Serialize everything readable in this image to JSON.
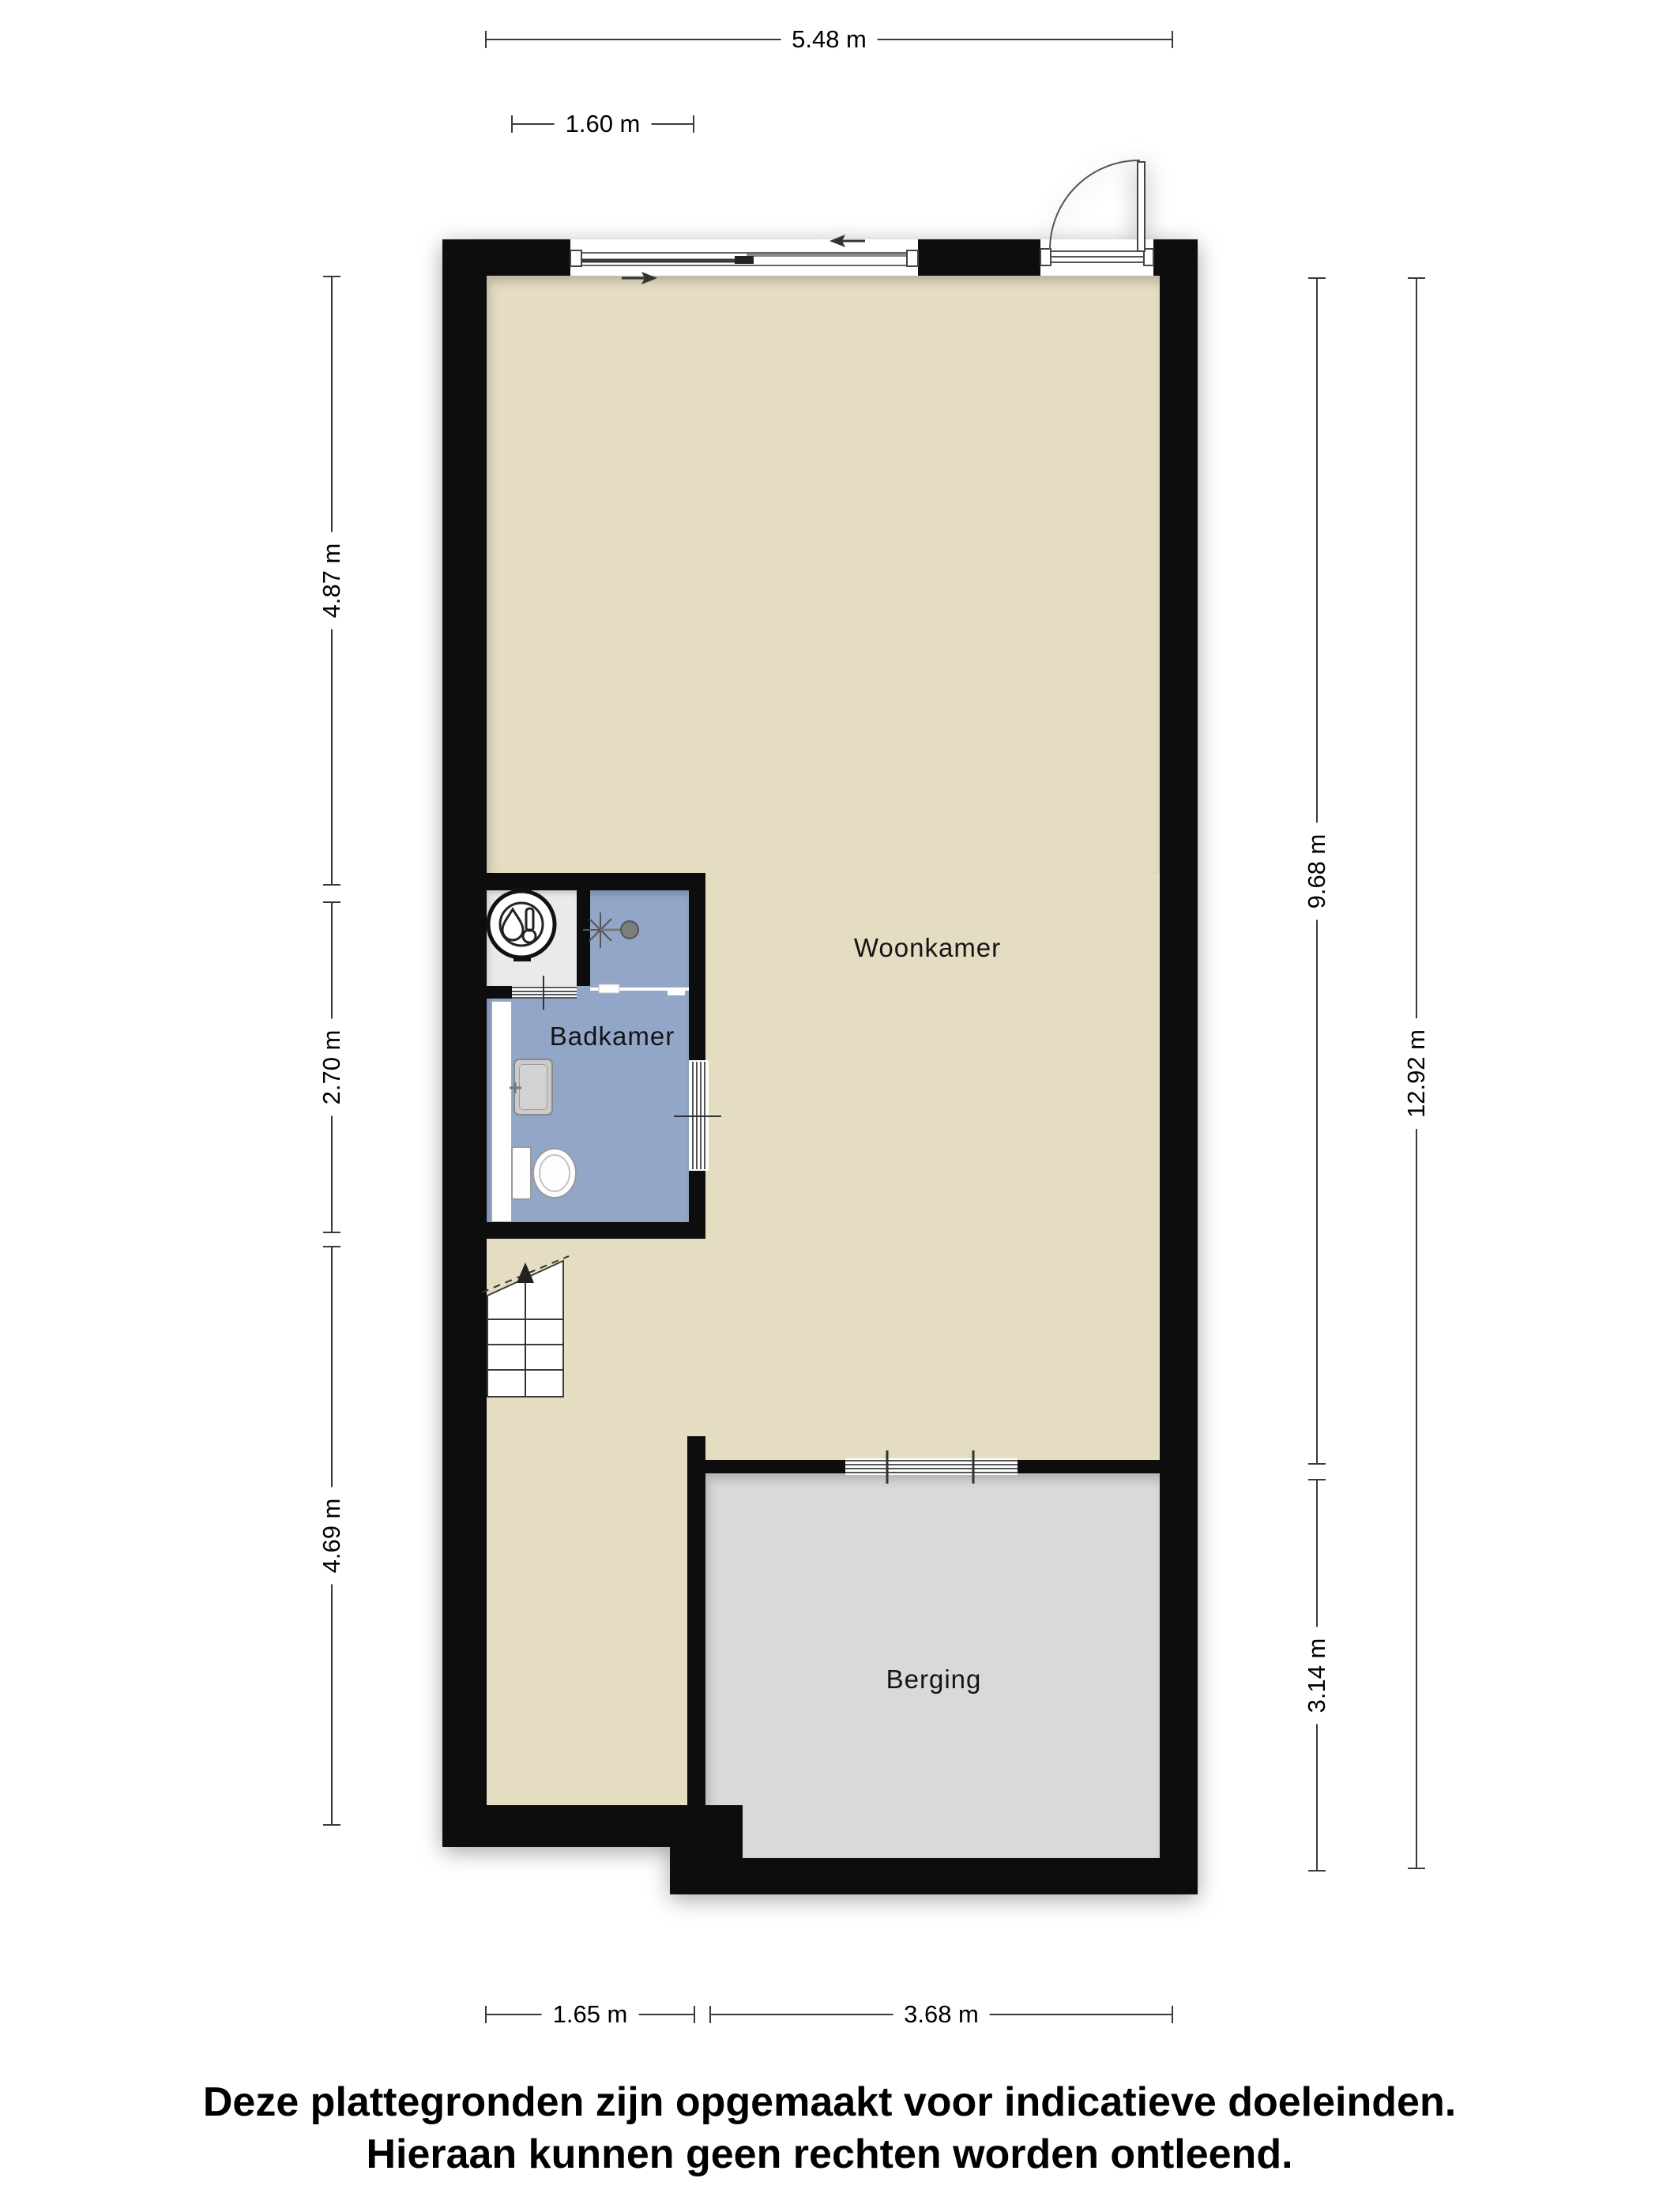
{
  "floorplan": {
    "rooms": {
      "woonkamer": {
        "label": "Woonkamer"
      },
      "badkamer": {
        "label": "Badkamer"
      },
      "berging": {
        "label": "Berging"
      }
    },
    "dimensions": {
      "top_total": {
        "label": "5.48 m"
      },
      "top_window": {
        "label": "1.60 m"
      },
      "left_upper": {
        "label": "4.87 m"
      },
      "left_middle": {
        "label": "2.70 m"
      },
      "left_lower": {
        "label": "4.69 m"
      },
      "right_upper": {
        "label": "9.68 m"
      },
      "right_lower": {
        "label": "3.14 m"
      },
      "right_total": {
        "label": "12.92 m"
      },
      "bottom_left": {
        "label": "1.65 m"
      },
      "bottom_right": {
        "label": "3.68 m"
      }
    },
    "icons": [
      "boiler-icon",
      "shower-icon",
      "sink-icon",
      "toilet-icon",
      "stairs-up-icon",
      "sliding-window-icon",
      "entry-door-icon",
      "berging-sliding-door-icon",
      "bathroom-door-icon",
      "closet-louvre-door-icon"
    ],
    "colors": {
      "wall": "#0d0d0d",
      "woonkamer_floor": "#e4ddc2",
      "badkamer_floor": "#92a7c8",
      "berging_floor": "#d9d9d9",
      "closet_floor": "#eaeaea",
      "dimension_line": "#3a3a3a"
    }
  },
  "disclaimer": {
    "line1": "Deze plattegronden zijn opgemaakt voor indicatieve doeleinden.",
    "line2": "Hieraan kunnen geen rechten worden ontleend."
  }
}
